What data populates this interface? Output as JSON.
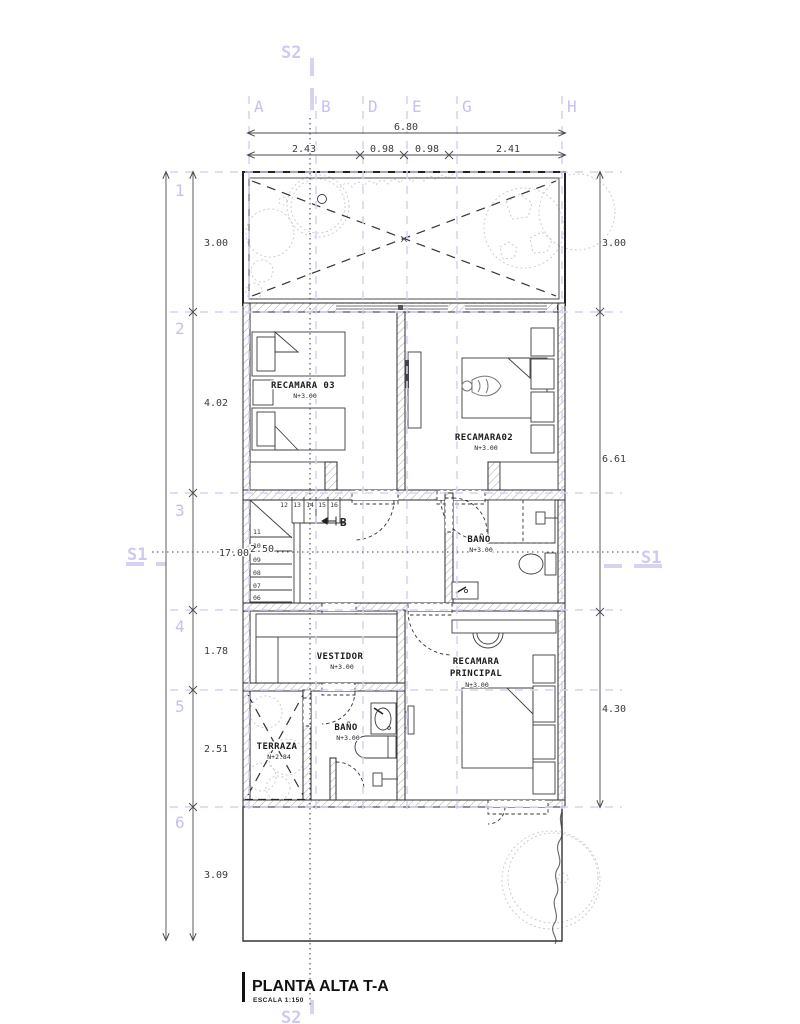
{
  "drawing_title": {
    "name": "PLANTA ALTA T-A",
    "scale": "ESCALA  1:150"
  },
  "grid": {
    "cols": [
      "A",
      "B",
      "D",
      "E",
      "G",
      "H"
    ],
    "rows": [
      "1",
      "2",
      "3",
      "4",
      "5",
      "6"
    ]
  },
  "sections": {
    "s2_top": "S2",
    "s2_bottom": "S2",
    "s1_left": "S1",
    "s1_right": "S1"
  },
  "dimensions": {
    "top_total": "6.80",
    "top_segs": [
      "2.43",
      "0.98",
      "0.98",
      "2.41"
    ],
    "left_total": "17.00",
    "left_segs": [
      "3.00",
      "4.02",
      "2.50",
      "1.78",
      "2.51",
      "3.09"
    ],
    "right_segs": [
      "3.00",
      "6.61",
      "4.30"
    ]
  },
  "rooms": {
    "recamara03": {
      "name": "RECAMARA 03",
      "level": "N+3.00"
    },
    "recamara02": {
      "name": "RECAMARA02",
      "level": "N+3.00"
    },
    "bano_upper": {
      "name": "BAÑO",
      "level": "N+3.00"
    },
    "vestidor": {
      "name": "VESTIDOR",
      "level": "N+3.00"
    },
    "recamara_principal": {
      "line1": "RECAMARA",
      "line2": "PRINCIPAL",
      "level": "N+3.00"
    },
    "bano_lower": {
      "name": "BAÑO",
      "level": "N+3.00"
    },
    "terraza": {
      "name": "TERRAZA",
      "level": "N+2.84"
    }
  },
  "stairs": {
    "upper_steps": [
      "12",
      "13",
      "14",
      "15",
      "16"
    ],
    "lower_steps": [
      "11",
      "10",
      "09",
      "08",
      "07",
      "06"
    ],
    "direction_marker": "B"
  },
  "colors": {
    "grid_line": "#d6d2f2",
    "grid_label": "#c6c0ed",
    "ink": "#2b2b2b",
    "dim": "#4a4a4a",
    "faint": "#cdcdcd"
  }
}
